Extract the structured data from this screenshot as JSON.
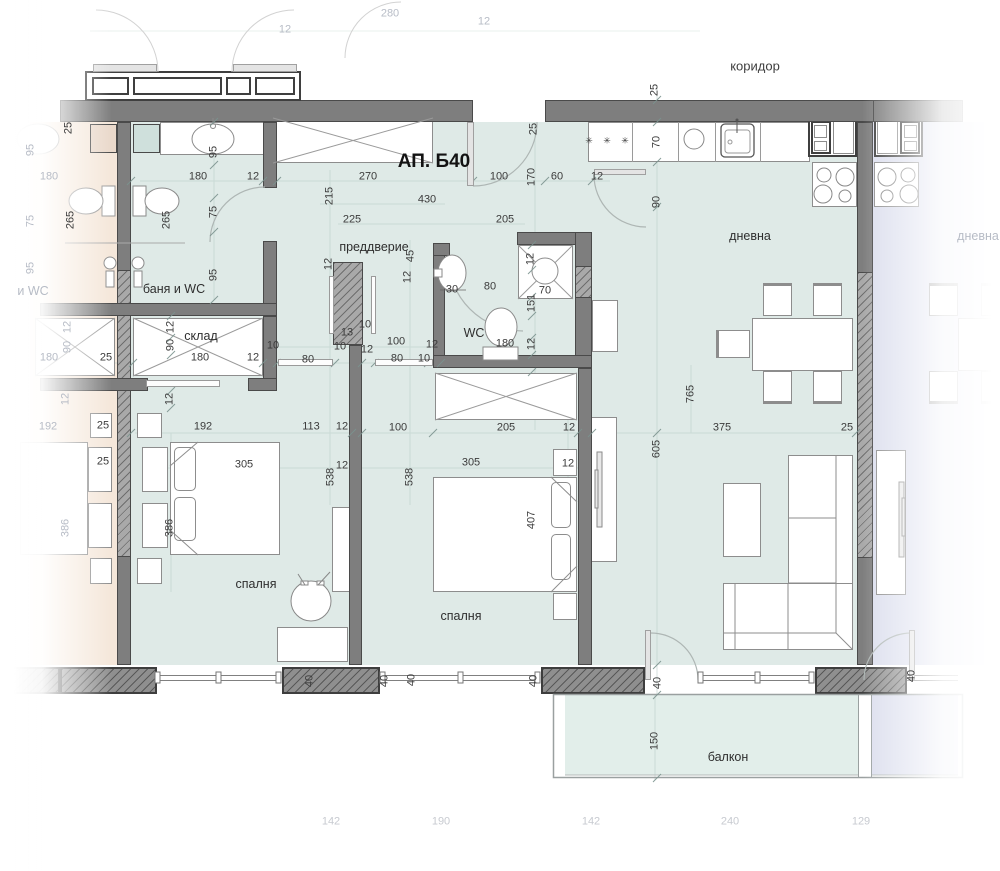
{
  "title": "АП. Б40",
  "labels": {
    "rooms": [
      {
        "text": "коридор",
        "x": 755,
        "y": 66,
        "style": "corridor"
      },
      {
        "text": "преддверие",
        "x": 374,
        "y": 247,
        "style": "room"
      },
      {
        "text": "баня и WC",
        "x": 174,
        "y": 289,
        "style": "room"
      },
      {
        "text": "склад",
        "x": 201,
        "y": 336,
        "style": "room"
      },
      {
        "text": "WC",
        "x": 474,
        "y": 333,
        "style": "room"
      },
      {
        "text": "дневна",
        "x": 750,
        "y": 236,
        "style": "room"
      },
      {
        "text": "спалня",
        "x": 256,
        "y": 584,
        "style": "room"
      },
      {
        "text": "спалня",
        "x": 461,
        "y": 616,
        "style": "room"
      },
      {
        "text": "балкон",
        "x": 728,
        "y": 757,
        "style": "room"
      },
      {
        "text": "дневна",
        "x": 978,
        "y": 236,
        "style": "room-faded"
      },
      {
        "text": "и WC",
        "x": 33,
        "y": 291,
        "style": "room-faded"
      }
    ],
    "dimensions": [
      {
        "value": "25",
        "x": 69,
        "y": 128,
        "o": "v"
      },
      {
        "value": "95",
        "x": 214,
        "y": 152,
        "o": "v"
      },
      {
        "value": "180",
        "x": 198,
        "y": 177,
        "o": "h"
      },
      {
        "value": "12",
        "x": 253,
        "y": 177,
        "o": "h"
      },
      {
        "value": "270",
        "x": 368,
        "y": 177,
        "o": "h"
      },
      {
        "value": "100",
        "x": 499,
        "y": 177,
        "o": "h"
      },
      {
        "value": "170",
        "x": 532,
        "y": 177,
        "o": "v"
      },
      {
        "value": "60",
        "x": 557,
        "y": 177,
        "o": "h"
      },
      {
        "value": "12",
        "x": 597,
        "y": 177,
        "o": "h"
      },
      {
        "value": "25",
        "x": 534,
        "y": 129,
        "o": "v"
      },
      {
        "value": "25",
        "x": 655,
        "y": 90,
        "o": "v"
      },
      {
        "value": "70",
        "x": 657,
        "y": 142,
        "o": "v"
      },
      {
        "value": "90",
        "x": 657,
        "y": 202,
        "o": "v"
      },
      {
        "value": "215",
        "x": 330,
        "y": 196,
        "o": "v"
      },
      {
        "value": "430",
        "x": 427,
        "y": 200,
        "o": "h"
      },
      {
        "value": "225",
        "x": 352,
        "y": 220,
        "o": "h"
      },
      {
        "value": "205",
        "x": 505,
        "y": 220,
        "o": "h"
      },
      {
        "value": "75",
        "x": 214,
        "y": 212,
        "o": "v"
      },
      {
        "value": "95",
        "x": 214,
        "y": 275,
        "o": "v"
      },
      {
        "value": "265",
        "x": 167,
        "y": 220,
        "o": "v"
      },
      {
        "value": "265",
        "x": 71,
        "y": 220,
        "o": "v"
      },
      {
        "value": "45",
        "x": 411,
        "y": 256,
        "o": "v"
      },
      {
        "value": "12",
        "x": 408,
        "y": 277,
        "o": "v"
      },
      {
        "value": "12",
        "x": 329,
        "y": 264,
        "o": "v"
      },
      {
        "value": "30",
        "x": 452,
        "y": 290,
        "o": "h"
      },
      {
        "value": "80",
        "x": 490,
        "y": 287,
        "o": "h"
      },
      {
        "value": "12",
        "x": 531,
        "y": 259,
        "o": "v"
      },
      {
        "value": "70",
        "x": 545,
        "y": 291,
        "o": "h"
      },
      {
        "value": "151",
        "x": 532,
        "y": 303,
        "o": "v"
      },
      {
        "value": "12",
        "x": 532,
        "y": 344,
        "o": "v"
      },
      {
        "value": "180",
        "x": 505,
        "y": 344,
        "o": "h"
      },
      {
        "value": "100",
        "x": 396,
        "y": 342,
        "o": "h"
      },
      {
        "value": "80",
        "x": 397,
        "y": 359,
        "o": "h"
      },
      {
        "value": "10",
        "x": 424,
        "y": 359,
        "o": "h"
      },
      {
        "value": "12",
        "x": 432,
        "y": 345,
        "o": "h"
      },
      {
        "value": "10",
        "x": 365,
        "y": 325,
        "o": "h"
      },
      {
        "value": "13",
        "x": 347,
        "y": 333,
        "o": "h"
      },
      {
        "value": "10",
        "x": 340,
        "y": 347,
        "o": "h"
      },
      {
        "value": "12",
        "x": 367,
        "y": 350,
        "o": "h"
      },
      {
        "value": "80",
        "x": 308,
        "y": 360,
        "o": "h"
      },
      {
        "value": "10",
        "x": 273,
        "y": 346,
        "o": "h"
      },
      {
        "value": "25",
        "x": 106,
        "y": 358,
        "o": "h"
      },
      {
        "value": "180",
        "x": 200,
        "y": 358,
        "o": "h"
      },
      {
        "value": "12",
        "x": 253,
        "y": 358,
        "o": "h"
      },
      {
        "value": "12",
        "x": 171,
        "y": 327,
        "o": "v"
      },
      {
        "value": "90",
        "x": 171,
        "y": 345,
        "o": "v"
      },
      {
        "value": "12",
        "x": 170,
        "y": 399,
        "o": "v"
      },
      {
        "value": "12",
        "x": 68,
        "y": 327,
        "o": "v",
        "s": "faded"
      },
      {
        "value": "90",
        "x": 68,
        "y": 347,
        "o": "v",
        "s": "faded"
      },
      {
        "value": "180",
        "x": 49,
        "y": 358,
        "o": "h",
        "s": "faded"
      },
      {
        "value": "12",
        "x": 66,
        "y": 399,
        "o": "v",
        "s": "faded"
      },
      {
        "value": "180",
        "x": 49,
        "y": 177,
        "o": "h",
        "s": "faded"
      },
      {
        "value": "95",
        "x": 31,
        "y": 150,
        "o": "v",
        "s": "faded"
      },
      {
        "value": "75",
        "x": 31,
        "y": 221,
        "o": "v",
        "s": "faded"
      },
      {
        "value": "95",
        "x": 31,
        "y": 268,
        "o": "v",
        "s": "faded"
      },
      {
        "value": "192",
        "x": 48,
        "y": 427,
        "o": "h",
        "s": "faded"
      },
      {
        "value": "192",
        "x": 203,
        "y": 427,
        "o": "h"
      },
      {
        "value": "113",
        "x": 311,
        "y": 427,
        "o": "h"
      },
      {
        "value": "12",
        "x": 342,
        "y": 427,
        "o": "h"
      },
      {
        "value": "100",
        "x": 398,
        "y": 428,
        "o": "h"
      },
      {
        "value": "205",
        "x": 506,
        "y": 428,
        "o": "h"
      },
      {
        "value": "12",
        "x": 569,
        "y": 428,
        "o": "h"
      },
      {
        "value": "375",
        "x": 722,
        "y": 428,
        "o": "h"
      },
      {
        "value": "25",
        "x": 847,
        "y": 428,
        "o": "h"
      },
      {
        "value": "25",
        "x": 103,
        "y": 426,
        "o": "h"
      },
      {
        "value": "25",
        "x": 103,
        "y": 462,
        "o": "h"
      },
      {
        "value": "305",
        "x": 244,
        "y": 465,
        "o": "h"
      },
      {
        "value": "12",
        "x": 342,
        "y": 466,
        "o": "h"
      },
      {
        "value": "538",
        "x": 331,
        "y": 477,
        "o": "v"
      },
      {
        "value": "538",
        "x": 410,
        "y": 477,
        "o": "v"
      },
      {
        "value": "305",
        "x": 471,
        "y": 463,
        "o": "h"
      },
      {
        "value": "12",
        "x": 568,
        "y": 464,
        "o": "h"
      },
      {
        "value": "407",
        "x": 532,
        "y": 520,
        "o": "v"
      },
      {
        "value": "386",
        "x": 170,
        "y": 528,
        "o": "v"
      },
      {
        "value": "386",
        "x": 66,
        "y": 528,
        "o": "v",
        "s": "faded"
      },
      {
        "value": "765",
        "x": 691,
        "y": 394,
        "o": "v"
      },
      {
        "value": "605",
        "x": 657,
        "y": 449,
        "o": "v"
      },
      {
        "value": "150",
        "x": 655,
        "y": 741,
        "o": "v"
      },
      {
        "value": "40",
        "x": 310,
        "y": 681,
        "o": "v"
      },
      {
        "value": "40",
        "x": 385,
        "y": 681,
        "o": "v"
      },
      {
        "value": "40",
        "x": 412,
        "y": 680,
        "o": "v"
      },
      {
        "value": "40",
        "x": 534,
        "y": 681,
        "o": "v"
      },
      {
        "value": "40",
        "x": 658,
        "y": 683,
        "o": "v"
      },
      {
        "value": "40",
        "x": 912,
        "y": 676,
        "o": "v"
      },
      {
        "value": "142",
        "x": 331,
        "y": 822,
        "o": "h",
        "s": "bottom"
      },
      {
        "value": "190",
        "x": 441,
        "y": 822,
        "o": "h",
        "s": "bottom"
      },
      {
        "value": "142",
        "x": 591,
        "y": 822,
        "o": "h",
        "s": "bottom"
      },
      {
        "value": "240",
        "x": 730,
        "y": 822,
        "o": "h",
        "s": "bottom"
      },
      {
        "value": "129",
        "x": 861,
        "y": 822,
        "o": "h",
        "s": "bottom"
      },
      {
        "value": "12",
        "x": 285,
        "y": 30,
        "o": "h",
        "s": "faded"
      },
      {
        "value": "280",
        "x": 390,
        "y": 14,
        "o": "h",
        "s": "faded"
      },
      {
        "value": "12",
        "x": 484,
        "y": 22,
        "o": "h",
        "s": "faded"
      }
    ],
    "symbols": [
      {
        "glyph": "✳ ✳ ✳",
        "x": 609,
        "y": 141
      }
    ]
  },
  "colors": {
    "apartment_floor": "#dfeae7",
    "neighbor_left_floor": "#f5e7da",
    "neighbor_right_floor": "#dcdfee",
    "balcony_floor": "#e2eeea",
    "wall": "#7e7e7e",
    "wall_outline": "#4a4a4a",
    "dimension_text": "#3b3b3b",
    "faded_text": "#b7bcc6"
  }
}
